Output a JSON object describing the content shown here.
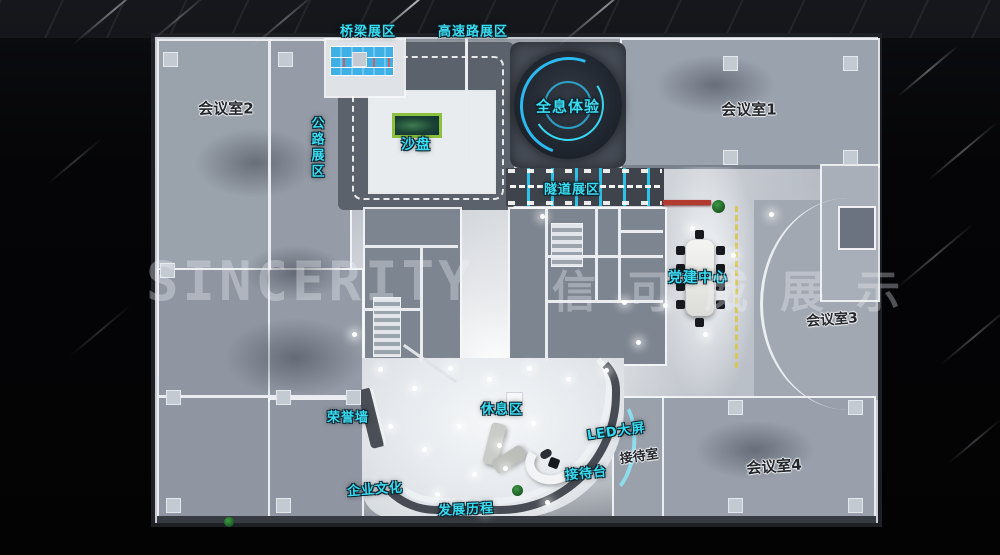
{
  "labels": {
    "bridge_zone": "桥梁展区",
    "highway_zone": "高速路展区",
    "road_zone": "公路展区",
    "hologram_zone": "全息体验",
    "sand_table": "沙盘",
    "tunnel_zone": "隧道展区",
    "meeting_room_1": "会议室1",
    "meeting_room_2": "会议室2",
    "meeting_room_3": "会议室3",
    "meeting_room_4": "会议室4",
    "party_building_center": "党建中心",
    "honor_wall": "荣誉墙",
    "rest_area": "休息区",
    "led_screen": "LED大屏",
    "reception_room": "接待室",
    "reception_desk": "接待台",
    "corporate_culture": "企业文化",
    "development_history": "发展历程"
  },
  "watermark": {
    "latin": "SINCERITY",
    "cjk": "信可威展示"
  },
  "colors": {
    "label_cyan": "#3bdcf0",
    "label_dark": "#23262d",
    "hologram_arc_blue": "#2bb9f0",
    "bridge_water_blue": "#3fb0e6",
    "sand_table_green": "#8cc13e",
    "banner_red": "#b23a2e",
    "road_dash_yellow": "#d8c84e",
    "road_gray": "#5c626b",
    "floor_light": "#f2f4f6",
    "background_dark": "#060608"
  }
}
